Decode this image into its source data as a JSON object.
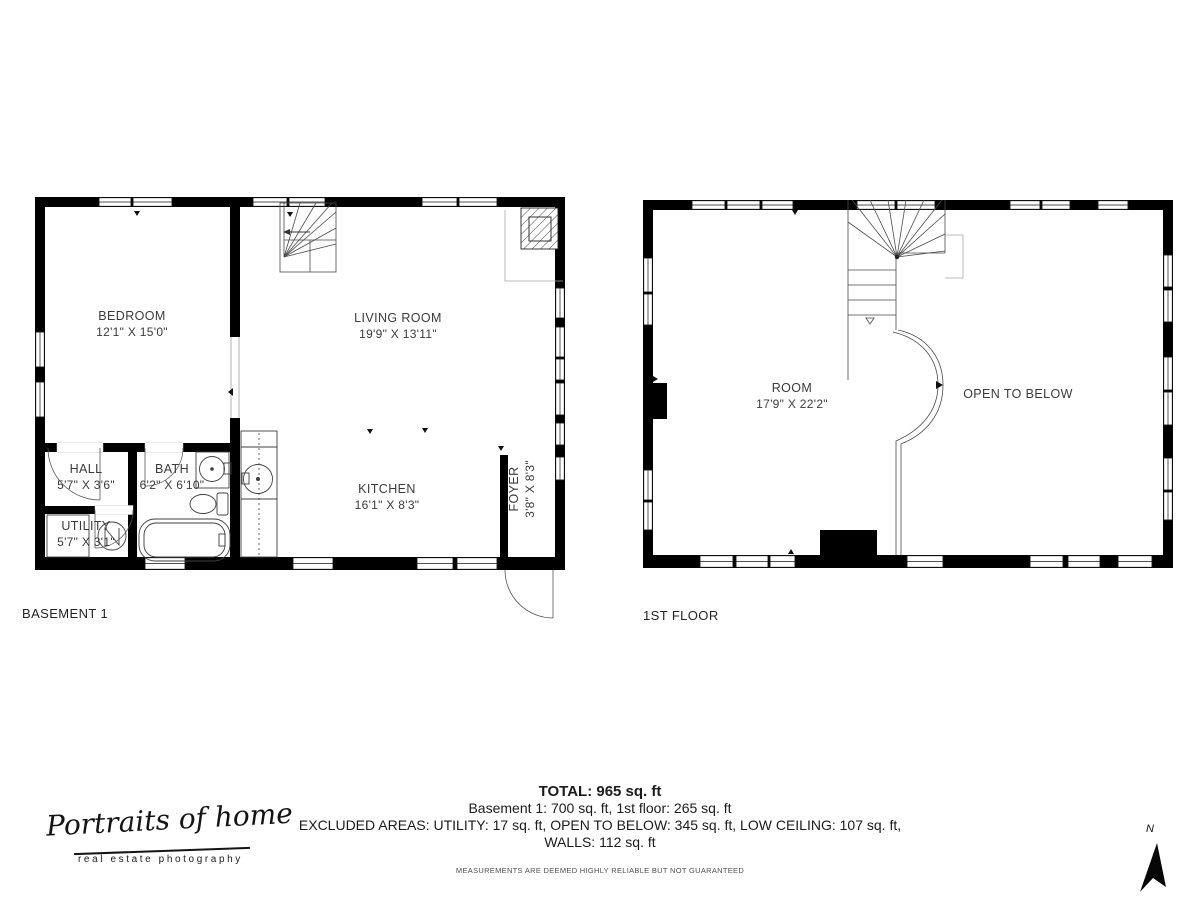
{
  "plans": {
    "basement": {
      "label": "BASEMENT 1",
      "rooms": {
        "bedroom": {
          "name": "BEDROOM",
          "dims": "12'1\" X 15'0\""
        },
        "living_room": {
          "name": "LIVING ROOM",
          "dims": "19'9\" X 13'11\""
        },
        "hall": {
          "name": "HALL",
          "dims": "5'7\" X 3'6\""
        },
        "bath": {
          "name": "BATH",
          "dims": "6'2\" X 6'10\""
        },
        "utility": {
          "name": "UTILITY",
          "dims": "5'7\" X 3'1\""
        },
        "kitchen": {
          "name": "KITCHEN",
          "dims": "16'1\" X 8'3\""
        },
        "foyer": {
          "name": "FOYER",
          "dims": "3'8\" X 8'3\""
        }
      }
    },
    "first_floor": {
      "label": "1ST FLOOR",
      "rooms": {
        "room": {
          "name": "ROOM",
          "dims": "17'9\" X 22'2\""
        },
        "open_to_below": {
          "name": "OPEN TO BELOW"
        }
      }
    }
  },
  "summary": {
    "total": "TOTAL: 965 sq. ft",
    "line2": "Basement 1: 700 sq. ft, 1st floor: 265 sq. ft",
    "line3": "EXCLUDED AREAS: UTILITY: 17 sq. ft, OPEN TO BELOW: 345 sq. ft, LOW CEILING: 107 sq. ft,",
    "line4": "WALLS: 112 sq. ft",
    "disclaimer": "MEASUREMENTS ARE DEEMED HIGHLY RELIABLE BUT NOT GUARANTEED"
  },
  "logo": {
    "script": "Portraits of home",
    "subtitle": "real estate photography"
  },
  "compass": {
    "label": "N"
  },
  "colors": {
    "wall": "#000000",
    "line": "#3f3f3f",
    "label": "#3b3b3b",
    "faint": "#a8a8a8"
  }
}
